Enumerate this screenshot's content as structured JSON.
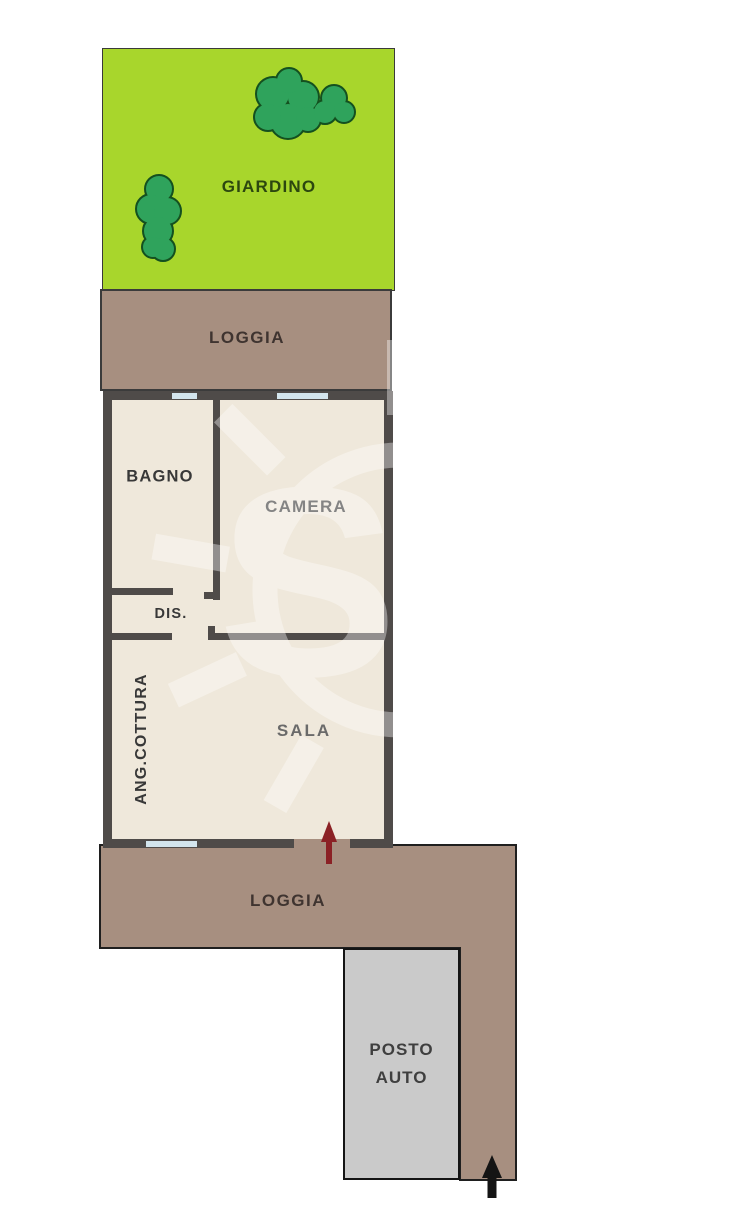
{
  "floorplan": {
    "areas": {
      "giardino": {
        "label": "GIARDINO"
      },
      "loggia_top": {
        "label": "LOGGIA"
      },
      "bagno": {
        "label": "BAGNO"
      },
      "camera": {
        "label": "CAMERA"
      },
      "disimpegno": {
        "label": "DIS."
      },
      "ang_cottura": {
        "label": "ANG.COTTURA"
      },
      "sala": {
        "label": "SALA"
      },
      "loggia_bottom": {
        "label": "LOGGIA"
      },
      "posto_auto": {
        "label": "POSTO AUTO"
      }
    },
    "watermark": {
      "letter": "S"
    },
    "colors": {
      "garden_green": "#A8D62C",
      "tree_green": "#2FA35C",
      "tree_outline": "#14501F",
      "loggia_brown": "#A78F80",
      "interior_beige": "#EFE8DB",
      "wall_dark": "#4F4B49",
      "window_blue": "#D3E5ED",
      "carport_gray": "#CACACA",
      "entrance_arrow_red": "#8B2125",
      "driveway_arrow_black": "#141414",
      "label_dark": "#383838",
      "label_sala": "#6A6A6A",
      "label_loggia": "#3F3430",
      "label_garden": "#2C470F",
      "label_carport": "#3F3F3F"
    }
  }
}
